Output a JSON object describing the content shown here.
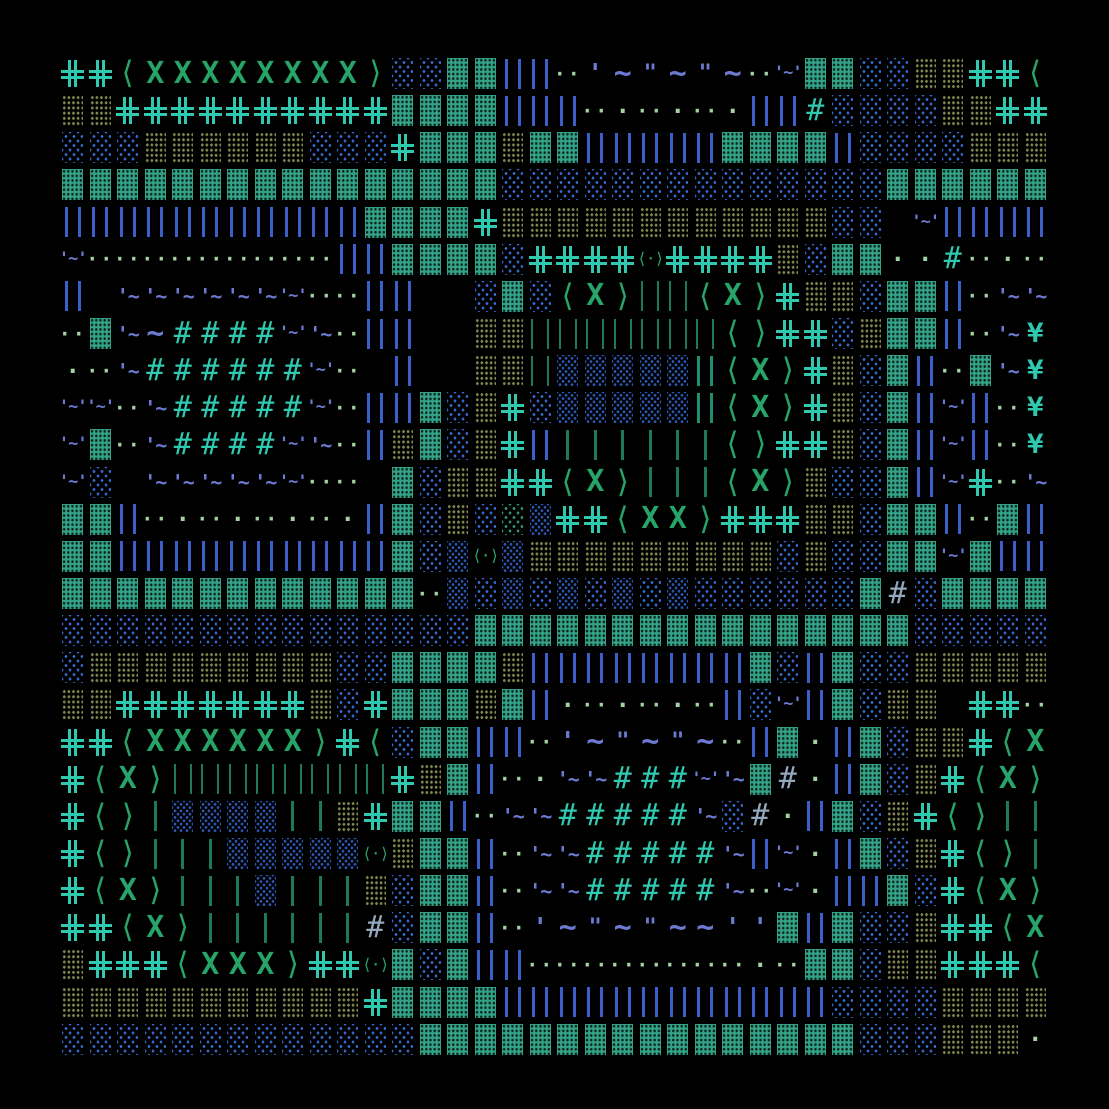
{
  "artwork": {
    "description": "generative textmode ascii-art grid on black background",
    "cols": 36,
    "rows": 27,
    "origin_x": 59,
    "origin_y": 55,
    "cell_w": 27.5,
    "cell_h": 37.15
  },
  "colors": {
    "background": "#000000",
    "teal": "#2fc9af",
    "green": "#27a468",
    "dkgreen": "#1d7a58",
    "tealbar": "#1f8f74",
    "blue": "#3a5fc8",
    "navy": "#2b55ad",
    "bluedot": "#3566c9",
    "tealdot": "#2f8f78",
    "olive": "#7e864f",
    "slate": "#6d7ad1",
    "pale": "#93a8bb",
    "ltgreen": "#a2d2a2",
    "block": "#33a287"
  },
  "palette": {
    "_": {
      "kind": "empty",
      "glyph": "blank"
    },
    "C": {
      "kind": "shape",
      "glyph": "double-line-cross"
    },
    "X": {
      "kind": "text",
      "char": "X",
      "glyph": "x-cross"
    },
    "<": {
      "kind": "text",
      "char": "⟨",
      "glyph": "angle-left"
    },
    ">": {
      "kind": "text",
      "char": "⟩",
      "glyph": "angle-right"
    },
    "O": {
      "kind": "text",
      "char": "⟨·⟩",
      "glyph": "angle-dot-pair"
    },
    "o": {
      "kind": "text",
      "char": "·",
      "glyph": "dot"
    },
    "p": {
      "kind": "text",
      "char": "··",
      "glyph": "dot-pair"
    },
    "B": {
      "kind": "shape",
      "glyph": "dense-teal-block"
    },
    "G": {
      "kind": "shape",
      "glyph": "olive-dotted-block"
    },
    "b": {
      "kind": "shape",
      "glyph": "sparse-blue-dotted-block"
    },
    "n": {
      "kind": "shape",
      "glyph": "navy-dotted-block"
    },
    "g": {
      "kind": "shape",
      "glyph": "sparse-teal-dotted-block"
    },
    "D": {
      "kind": "shape",
      "glyph": "blue-double-bar"
    },
    "T": {
      "kind": "shape",
      "glyph": "teal-double-bar"
    },
    "i": {
      "kind": "shape",
      "glyph": "thin-green-bar"
    },
    "F": {
      "kind": "shape",
      "glyph": "thin-green-double-bar"
    },
    "t": {
      "kind": "text",
      "char": "~",
      "glyph": "tilde-wave"
    },
    "a": {
      "kind": "text",
      "char": "'",
      "glyph": "tick"
    },
    "u": {
      "kind": "text",
      "char": "\"",
      "glyph": "double-tick"
    },
    "w": {
      "kind": "text",
      "char": "'~",
      "glyph": "tick-tilde"
    },
    "W": {
      "kind": "text",
      "char": "'~'",
      "glyph": "tick-tilde-tick"
    },
    "h": {
      "kind": "text",
      "char": "#",
      "glyph": "hash-teal"
    },
    "H": {
      "kind": "text",
      "char": "#",
      "glyph": "hash-pale"
    },
    "Y": {
      "kind": "text",
      "char": "¥",
      "glyph": "yen-glyph"
    }
  },
  "grid": [
    "CC<XXXXXXXX>bbBBDDpatututpWBBbbGGCC<",
    "GGCCCCCCCCCCBBBBDDDpopopoDDhbbbbGGCC",
    "bbbGGGGGGbbbCBBBGBBDDDDDBBBBDbbbbGGG",
    "BBBBBBBBBBBBBBBBbbbbbbbbbbbbbbBBBBBB",
    "DDDDDDDDDDDBBBBCGGGGGGGGGGGGbb_WDDDD",
    "WpppppppppDDBBBBbCCCCOCCCCGbBBoohpop",
    "D_wwwwwwWppDD__bBb<X>FF<X>CGGbBBDpww",
    "pBwthhhhWwpDD__GGFFFFFFF<>CCbGBBDpwY",
    "opwhhhhhhWp_D__GGFnnnnnT<X>CGbBDpBwY",
    "WWpwhhhhhWpDDBbGCbnnnnnT<X>CGbBDWDpY",
    "WBpwhhhhWwpDGBbGCDiiiiii<>CCGbBDWDpY",
    "Wb_wwwwwWpp_BbGGCC<X>iii<X>GbbBDWCpw",
    "BBDpopopopoDBbGbgnCC<XX>CCCGGbBBDpBD",
    "BBDDDDDDDDDDBbnOnGGGGGGGGGbGbbBBWBDD",
    "BBBBBBBBBBBBBpnbnbnbnbnbbbbbbBHbBBBB",
    "bbbbbbbbbbbbbbbBBBBBBBBBBBBBBBBbbbbb",
    "bGGGGGGGGGbbBBBBGDDDDDDDDBbDBbbGGGGG",
    "GGCCCCCCCGbCBBBGBDopopopDbWDBbGG_CCp",
    "CC<XXXXXX>C<bBBDDpatututpDBoDBbGGC<X",
    "C<X>FFFFFFFFCGBDpowwhhhWwBHoDBbGC<X>",
    "C<>innnniiGCBBDpwwhhhhhwbHoDBbGC<>ii",
    "C<>iiinnnnnOGBBDpwwhhhhhwDWoDBbGC<>i",
    "C<X>iiiniiiGbBBDpwwhhhhhwpWoDDBbC<X>",
    "CC<X>iiiiiiHbBBDpatututtaaBDBbbGCC<X",
    "GCCC<XXX>CCOBbBDDppppppppopBBbGGCCC<",
    "GGGGGGGGGGGCBBBBDDDDDDDDDDDDbbbbGGGG",
    "bbbbbbbbbbbbbBBBBBBBBBBBBBBBBbbbGGGo"
  ]
}
